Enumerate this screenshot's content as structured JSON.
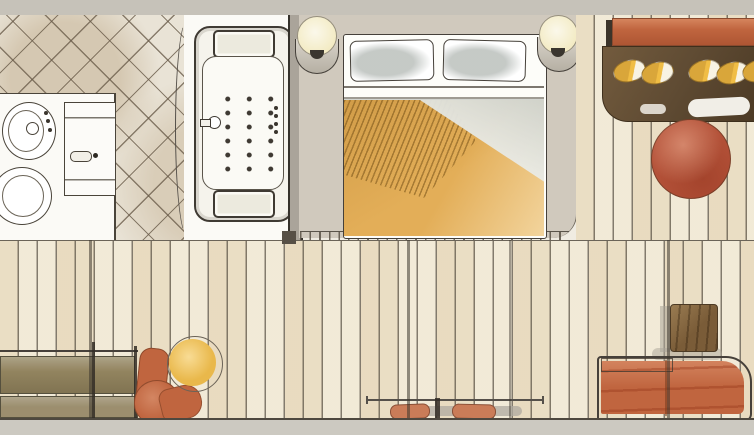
{
  "meta": {
    "title": "Watercolor hotel suite floor plan",
    "medium": "hand-drawn watercolor sketch",
    "view": "top-down architectural plan",
    "text_content": "none (drawing only)"
  },
  "palette": {
    "wall_gray": "#c6c2b9",
    "band_gray": "#ccc9c1",
    "floor_cream": "#f2ebd9",
    "plank_line": "#585044",
    "tile_beige": "#e9e3d6",
    "tile_line": "#685a48",
    "carpet_gray": "#d0c9bd",
    "sketch_ink": "#4a443a",
    "terracotta": "#c0653f",
    "rust_red": "#b35138",
    "amber_bedspread": "#e3ae58",
    "gold": "#e9b84b",
    "dark_brown_wardrobe": "#5f4b33",
    "olive_bench": "#92845f",
    "bench_seat": "#9c8e6e",
    "cushion_clay": "#ca7c58",
    "table_brown": "#7a5c38",
    "lamp_cream": "#f3ebc4",
    "linen_white": "#fdfcf8"
  },
  "rooms": {
    "bathroom": {
      "name": "Bathroom",
      "floor": "diagonal ceramic tile",
      "elements": [
        {
          "name": "bidet",
          "detail": "oval fixture with spray nozzle and 3 control dots"
        },
        {
          "name": "toilet",
          "detail": "oval bowl, partially cut by left edge"
        },
        {
          "name": "wc-door",
          "detail": "panel with pill handle"
        },
        {
          "name": "jacuzzi-bathtub",
          "detail": "2 headrests, 18 jets, side faucet, 4 control knobs",
          "jets": 18,
          "headrests": 2
        },
        {
          "name": "glass-partition",
          "detail": "curved glass line left of tub"
        }
      ]
    },
    "bedroom": {
      "name": "Bedroom",
      "floor": "gray carpet platform with stitched edge",
      "elements": [
        {
          "name": "double-bed",
          "detail": "2 gray-shaded pillows, folded white sheet, amber hatched bedspread"
        },
        {
          "name": "wall-sconce-left",
          "detail": "cream globe lamp on half-round bracket"
        },
        {
          "name": "wall-sconce-right",
          "detail": "cream globe lamp on half-round bracket"
        }
      ]
    },
    "wardrobe_corner": {
      "name": "Wardrobe corner",
      "elements": [
        {
          "name": "console-shelf",
          "color_key": "terracotta"
        },
        {
          "name": "wardrobe",
          "detail": "dark brown open shelf with 5 golden items",
          "items": 5,
          "color_key": "dark_brown_wardrobe"
        },
        {
          "name": "round-pouf",
          "color_key": "rust_red"
        }
      ]
    },
    "living_area": {
      "name": "Living area",
      "floor": "vertical wood planks",
      "elements": [
        {
          "name": "bench-sofa",
          "detail": "two-tier olive bench along left wall",
          "color_key": "olive_bench"
        },
        {
          "name": "corner-armchair",
          "color_key": "terracotta"
        },
        {
          "name": "round-side-table",
          "detail": "hand-drawn offset outline",
          "color_key": "gold"
        },
        {
          "name": "window-bench",
          "detail": "rail with 2 clay cushions and gray ledge"
        },
        {
          "name": "daybed-sofa",
          "detail": "rounded right corner, streaked wash",
          "color_key": "terracotta"
        },
        {
          "name": "square-side-table",
          "color_key": "table_brown"
        }
      ]
    }
  }
}
